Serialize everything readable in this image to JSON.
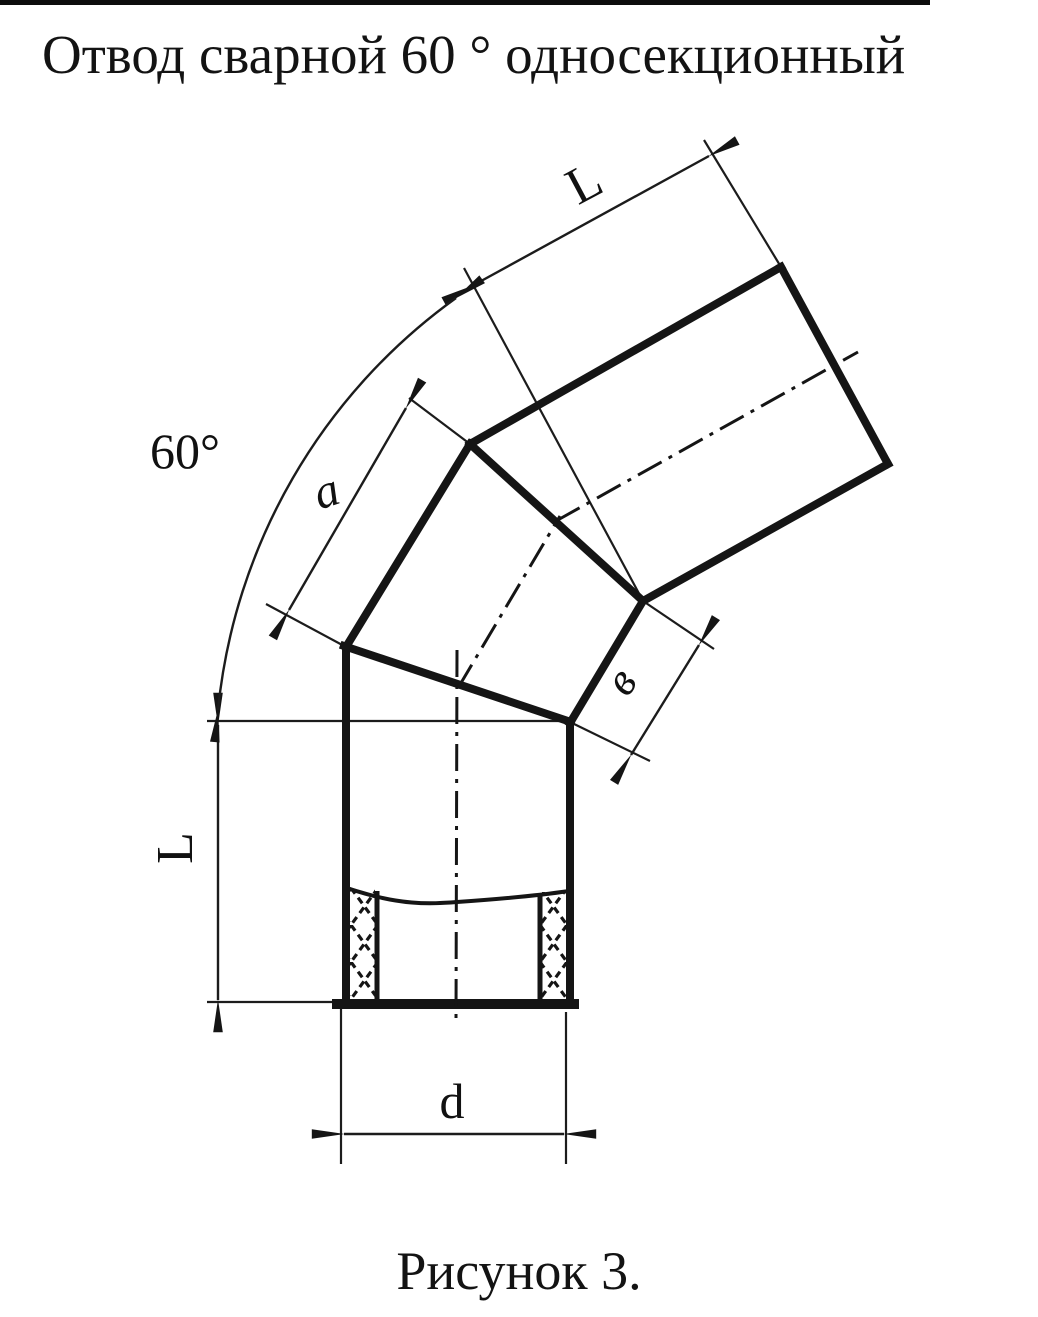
{
  "title": "Отвод сварной 60 ° односекционный",
  "caption": "Рисунок 3.",
  "diagram": {
    "description": "welded single-section 60 degree pipe elbow, technical drawing",
    "labels": {
      "angle": "60°",
      "top_length": "L",
      "section_length": "a",
      "section_short": "в",
      "left_length": "L",
      "diameter": "d"
    },
    "colors": {
      "ink": "#151515",
      "paper": "#ffffff"
    }
  }
}
